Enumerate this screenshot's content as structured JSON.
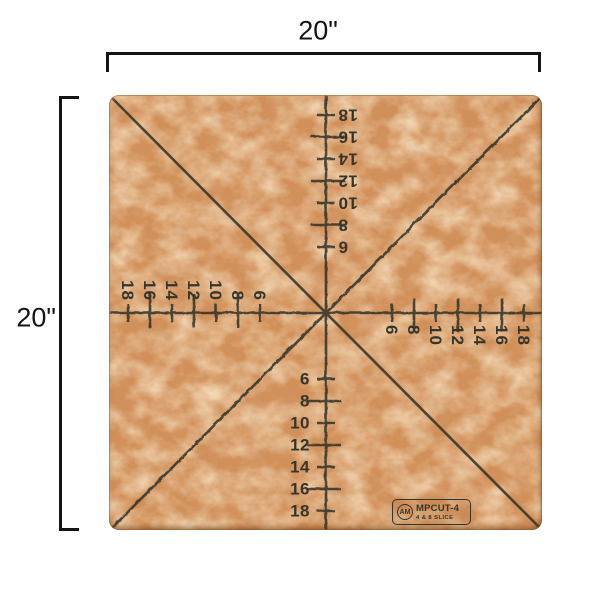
{
  "dimensions": {
    "width_label": "20\"",
    "height_label": "20\""
  },
  "board": {
    "scale_values": [
      6,
      8,
      10,
      12,
      14,
      16,
      18
    ],
    "scale_axes": [
      "top",
      "right",
      "bottom",
      "left"
    ],
    "cut_lines": [
      "vertical-center",
      "horizontal-center",
      "diagonal-tlbr",
      "diagonal-trbl"
    ]
  },
  "badge": {
    "logo_monogram": "AM",
    "model": "MPCUT-4",
    "subtitle": "4 & 8 SLICE"
  },
  "colors": {
    "background": "#ffffff",
    "dimension_ink": "#141414",
    "marking_ink": "#35352b",
    "board_surface": "#d2905a",
    "board_light": "#eec48f",
    "board_dark": "#b2763e"
  }
}
